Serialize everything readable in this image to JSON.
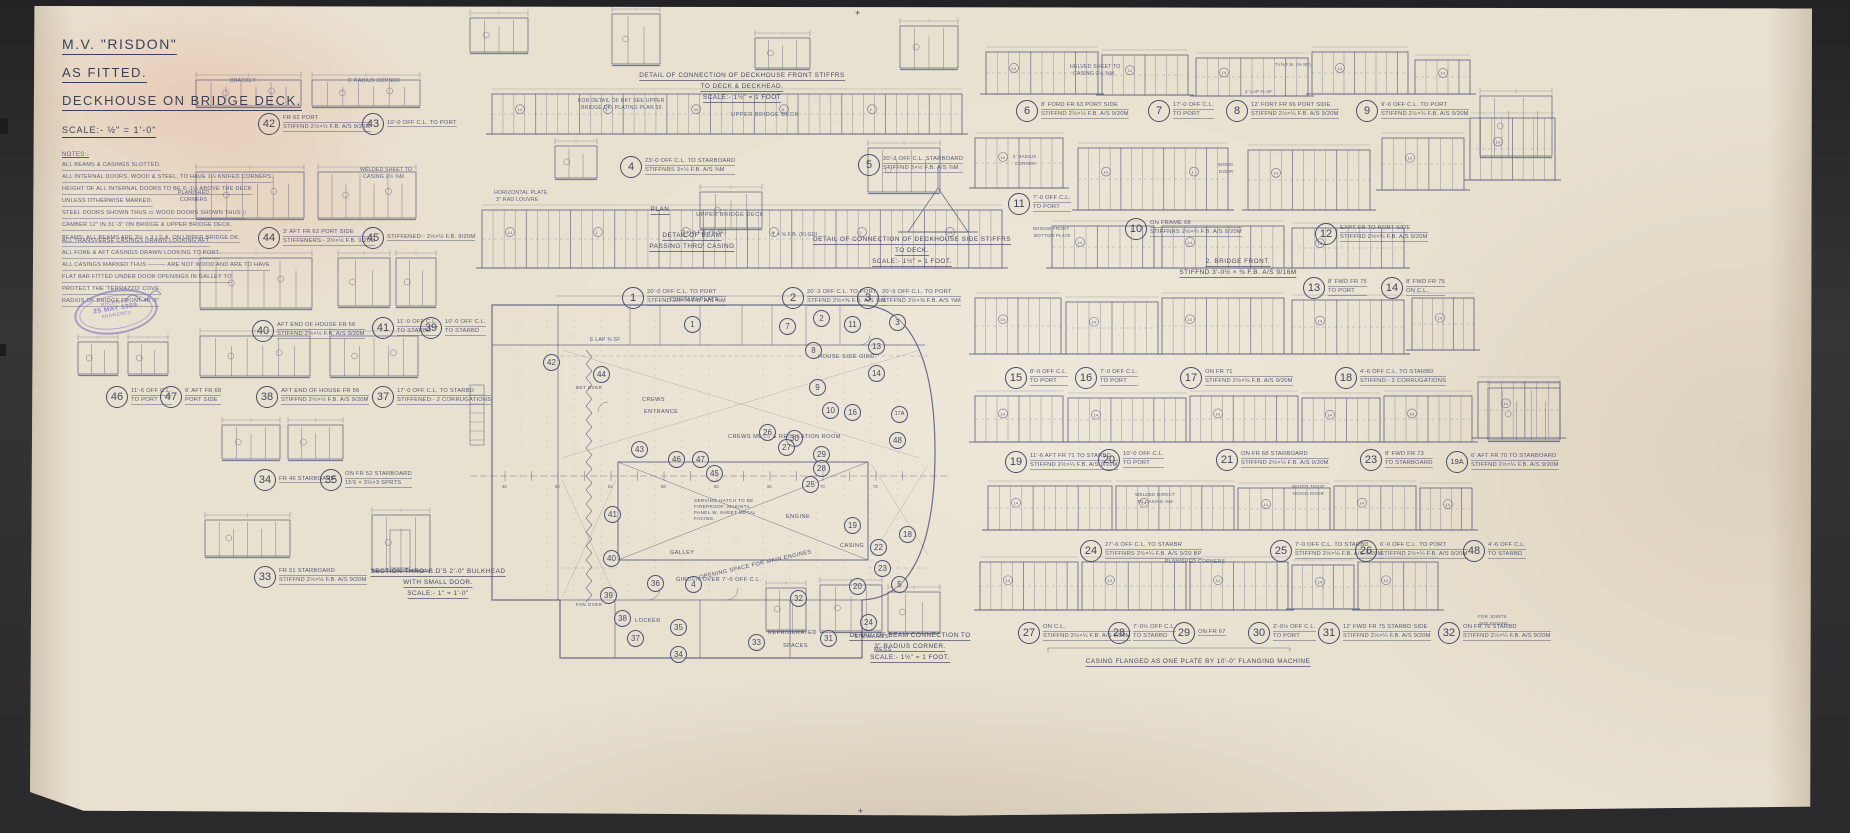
{
  "window": {
    "width": 1850,
    "height": 833
  },
  "colors": {
    "ink": "#464c68",
    "ink_light": "#5b6282",
    "paper": "#e9e1d0",
    "stamp": "#7d74c0",
    "surround": "#2d2d2f"
  },
  "title_block": {
    "vessel": "M.V. \"RISDON\"",
    "status": "AS FITTED.",
    "subject": "DECKHOUSE ON BRIDGE DECK.",
    "scale": "SCALE:- ½\" = 1'-0\"",
    "notes_heading": "NOTES:-",
    "notes": [
      "ALL BEAMS & CASINGS SLOTTED.",
      "ALL INTERNAL DOORS, WOOD & STEEL, TO HAVE 1¼ KNIFED CORNERS.",
      "HEIGHT OF ALL INTERNAL DOORS TO BE 6'-1½ ABOVE THE DECK",
      "UNLESS OTHERWISE MARKED.",
      "STEEL DOORS SHOWN THUS ▭    WOOD DOORS SHOWN THUS ▯",
      "CAMBER 12\" IN 31'-3\" ON BRIDGE & UPPER BRIDGE DECK.",
      "BEAMS: ALL BEAMS ARE 3½ × 3  I.S.A. ON UPPER BRIDGE DK."
    ],
    "notes2": [
      "ALL TRANSVERSE CASINGS DRAWN LOOKING AFT.",
      "ALL FORE & AFT CASINGS DRAWN LOOKING TO PORT.",
      "ALL CASINGS MARKED THUS ——— ARE NOT WOOD AND ARE TO HAVE",
      "FLAT BAR FITTED UNDER DOOR OPENINGS IN GALLEY TO",
      "PROTECT THE 'TERRAZZO' COVE.",
      "RADIUS OF BRIDGE FRONT 48'-3\""
    ]
  },
  "stamp": {
    "top": "RECEIVED",
    "date": "25 MAY 1959",
    "bottom": "ANSWERED"
  },
  "headings": [
    {
      "x": 712,
      "y": 66,
      "lines": [
        "DETAIL OF CONNECTION OF DECKHOUSE FRONT STIFFRS",
        "TO DECK & DECKHEAD.",
        "SCALE:- 1½\" = 1 FOOT"
      ]
    },
    {
      "x": 630,
      "y": 200,
      "lines": [
        "PLAN"
      ]
    },
    {
      "x": 662,
      "y": 226,
      "lines": [
        "DETAIL OF BEAM",
        "PASSING THRO' CASING"
      ]
    },
    {
      "x": 882,
      "y": 230,
      "lines": [
        "DETAIL OF CONNECTION OF DECKHOUSE SIDE STIFFRS",
        "TO DECK.",
        "SCALE:- 1½\" = 1 FOOT."
      ]
    },
    {
      "x": 880,
      "y": 626,
      "lines": [
        "DETAIL OF BEAM CONNECTION TO",
        "3\" RADIUS CORNER.",
        "SCALE:- 1½\" = 1 FOOT."
      ]
    },
    {
      "x": 408,
      "y": 562,
      "lines": [
        "SECTION THRO' B.D'S 2'-0\" BULKHEAD",
        "WITH SMALL DOOR.",
        "SCALE:- 1\" = 1'-0\""
      ]
    },
    {
      "x": 1208,
      "y": 252,
      "lines": [
        "2. BRIDGE FRONT.",
        "STIFFND 3'-0½ × ⅜ F.B. A/S 9/16M"
      ]
    },
    {
      "x": 1168,
      "y": 652,
      "lines": [
        "CASING FLANGED AS ONE PLATE BY 10'-0\" FLANGING MACHINE"
      ]
    },
    {
      "x": 735,
      "y": 106,
      "small": true,
      "lines": [
        "UPPER BRIDGE DECK"
      ]
    },
    {
      "x": 700,
      "y": 206,
      "small": true,
      "lines": [
        "UPPER BRIDGE DECK"
      ]
    }
  ],
  "details": [
    {
      "n": "42",
      "x": 228,
      "y": 107,
      "lines": [
        "FR 62 PORT",
        "STIFFND 2½×½ F.B. A/S 9/20M"
      ],
      "sk": [
        196,
        80,
        105,
        26
      ]
    },
    {
      "n": "43",
      "x": 332,
      "y": 107,
      "lines": [
        "10'-0 OFF C.L. TO PORT"
      ],
      "sk": [
        312,
        80,
        108,
        26
      ]
    },
    {
      "n": "44",
      "x": 228,
      "y": 221,
      "lines": [
        "3' AFT FR 62 PORT SIDE",
        "STIFFENERS:- 2½×½ F.B. 9/20M"
      ],
      "sk": [
        196,
        172,
        108,
        46
      ]
    },
    {
      "n": "45",
      "x": 332,
      "y": 221,
      "lines": [
        "STIFFENED:- 2½×½ F.B. 9/20M"
      ],
      "sk": [
        318,
        172,
        98,
        46
      ]
    },
    {
      "n": "40",
      "x": 222,
      "y": 314,
      "lines": [
        "AFT END OF HOUSE FR 56",
        "STIFFND 2½×½ F.B. A/S 9/20M"
      ],
      "sk": [
        200,
        258,
        112,
        50
      ]
    },
    {
      "n": "41",
      "x": 342,
      "y": 311,
      "lines": [
        "11'-0 OFF C.L.",
        "TO STARBD"
      ],
      "sk": [
        338,
        258,
        52,
        48
      ]
    },
    {
      "n": "39",
      "x": 390,
      "y": 311,
      "lines": [
        "10'-0 OFF C.L.",
        "TO STARBD"
      ],
      "sk": [
        396,
        258,
        40,
        48
      ]
    },
    {
      "n": "46",
      "x": 76,
      "y": 380,
      "lines": [
        "11'-6 OFF C.L.",
        "TO PORT"
      ],
      "sk": [
        78,
        342,
        40,
        32
      ]
    },
    {
      "n": "47",
      "x": 130,
      "y": 380,
      "lines": [
        "6' AFT FR 68",
        "PORT SIDE"
      ],
      "sk": [
        128,
        342,
        40,
        32
      ]
    },
    {
      "n": "38",
      "x": 226,
      "y": 380,
      "lines": [
        "AFT END OF HOUSE FR 56",
        "STIFFND 2½×½ F.B. A/S 9/20M"
      ],
      "sk": [
        200,
        336,
        110,
        40
      ]
    },
    {
      "n": "37",
      "x": 342,
      "y": 380,
      "lines": [
        "17'-0 OFF C.L. TO STARBD",
        "STIFFENED:- 2 CORRUGATIONS"
      ],
      "sk": [
        330,
        336,
        88,
        40
      ]
    },
    {
      "n": "34",
      "x": 224,
      "y": 463,
      "lines": [
        "FR 46 STARBOARD"
      ],
      "sk": [
        222,
        425,
        58,
        34
      ]
    },
    {
      "n": "35",
      "x": 290,
      "y": 463,
      "lines": [
        "ON FR 52 STARBOARD",
        "15'6 × 3½×3 SPRTS"
      ],
      "sk": [
        288,
        425,
        55,
        34
      ]
    },
    {
      "n": "33",
      "x": 224,
      "y": 560,
      "lines": [
        "FR 51 STARBOARD",
        "STIFFND 2½×½ F.B. A/S 9/20M"
      ],
      "sk": [
        205,
        520,
        85,
        36
      ]
    },
    {
      "n": "4",
      "x": 590,
      "y": 150,
      "lines": [
        "23'-0 OFF C.L. TO STARBOARD",
        "STIFFNRS 3×½ F.B. A/S ⅜M"
      ]
    },
    {
      "n": "5",
      "x": 828,
      "y": 148,
      "lines": [
        "20'-3 OFF C.L. STARBOARD",
        "STIFFND 3×½ F.B. A/S ⅜M"
      ]
    },
    {
      "n": "1",
      "x": 592,
      "y": 281,
      "lines": [
        "20'-0 OFF C.L. TO PORT",
        "STFFND 2½×⅜ F.B. A/S ⅜M"
      ]
    },
    {
      "n": "2",
      "x": 752,
      "y": 281,
      "lines": [
        "20'-3 OFF C.L. TO PORT",
        "STFFND 2½×⅜ F.B. A/S ⅜M"
      ]
    },
    {
      "n": "3",
      "x": 827,
      "y": 281,
      "lines": [
        "20'-9 OFF C.L. TO PORT",
        "STFFND 2½×⅜ F.B. A/S ⅜M"
      ]
    },
    {
      "n": "6",
      "x": 986,
      "y": 94,
      "lines": [
        "8' FORD FR 63 PORT SIDE",
        "STIFFND 2½×¼ F.B. A/S 9/20M"
      ]
    },
    {
      "n": "7",
      "x": 1118,
      "y": 94,
      "lines": [
        "17'-0 OFF C.L.",
        "TO PORT"
      ]
    },
    {
      "n": "8",
      "x": 1196,
      "y": 94,
      "lines": [
        "12' FORT FR 66 PORT SIDE",
        "STIFFND 2½×¼ F.B. A/S 9/20M"
      ]
    },
    {
      "n": "9",
      "x": 1326,
      "y": 94,
      "lines": [
        "9'-6 OFF C.L. TO PORT",
        "STIFFND 2½×¼ F.B. A/S 9/20M"
      ]
    },
    {
      "n": "11",
      "x": 978,
      "y": 187,
      "lines": [
        "7'-0 OFF C.L.",
        "TO PORT"
      ]
    },
    {
      "n": "10",
      "x": 1095,
      "y": 212,
      "lines": [
        "ON FRAME 68",
        "STIFFNRS 2½×¼ F.B. A/S 9/20M"
      ]
    },
    {
      "n": "12",
      "x": 1285,
      "y": 217,
      "lines": [
        "EXPT FR TO PORT SIDE",
        "STIFFND 2½×¼ F.B. A/S 9/20M"
      ]
    },
    {
      "n": "13",
      "x": 1273,
      "y": 271,
      "lines": [
        "8' FWD FR 75",
        "TO PORT"
      ]
    },
    {
      "n": "14",
      "x": 1351,
      "y": 271,
      "lines": [
        "8' FWD FR 75",
        "ON C.L."
      ]
    },
    {
      "n": "15",
      "x": 975,
      "y": 361,
      "lines": [
        "8'-0 OFF C.L.",
        "TO PORT"
      ]
    },
    {
      "n": "16",
      "x": 1045,
      "y": 361,
      "lines": [
        "7'-0 OFF C.L.",
        "TO PORT"
      ]
    },
    {
      "n": "17",
      "x": 1150,
      "y": 361,
      "lines": [
        "ON FR 71",
        "STIFFND 2½×¼ F.B. A/S 9/20M"
      ]
    },
    {
      "n": "18",
      "x": 1305,
      "y": 361,
      "lines": [
        "4'-6 OFF C.L. TO STARBD",
        "STIFFND:- 2 CORRUGATIONS"
      ]
    },
    {
      "n": "19",
      "x": 975,
      "y": 445,
      "lines": [
        "11'-6 AFT FR 71 TO STARBD",
        "STIFFND 2½×¼ F.B. A/S 9/20M"
      ]
    },
    {
      "n": "20",
      "x": 1068,
      "y": 443,
      "lines": [
        "10'-0 OFF C.L.",
        "TO PORT"
      ]
    },
    {
      "n": "21",
      "x": 1186,
      "y": 443,
      "lines": [
        "ON FR 68 STARBOARD",
        "STIFFND 2½×¼ F.B. A/S 9/20M"
      ]
    },
    {
      "n": "23",
      "x": 1330,
      "y": 443,
      "lines": [
        "8' FWD FR 73",
        "TO STARBOARD"
      ]
    },
    {
      "n": "19A",
      "x": 1416,
      "y": 445,
      "lines": [
        "6' AFT FR 70 TO STARBOARD",
        "STIFFND 2½×¼ F.B. A/S 9/20M"
      ]
    },
    {
      "n": "24",
      "x": 1050,
      "y": 534,
      "lines": [
        "27'-6 OFF C.L. TO STARBR",
        "STIFFNRS 2½×¼ F.B. A/S 9/20 BP"
      ]
    },
    {
      "n": "25",
      "x": 1240,
      "y": 534,
      "lines": [
        "7'-0 OFF C.L. TO STARBD",
        "STIFFND 2½×¼ F.B. A/S 9/20M"
      ]
    },
    {
      "n": "26",
      "x": 1325,
      "y": 534,
      "lines": [
        "6'-0 OFF C.L. TO PORT",
        "STIFFND 2½×¼ F.B. A/S 9/20M"
      ]
    },
    {
      "n": "48",
      "x": 1433,
      "y": 534,
      "lines": [
        "4'-6 OFF C.L.",
        "TO STARBD"
      ]
    },
    {
      "n": "27",
      "x": 988,
      "y": 616,
      "lines": [
        "ON C.L.",
        "STIFFND 2½×¼ F.B. A/S 9/20M"
      ]
    },
    {
      "n": "28",
      "x": 1078,
      "y": 616,
      "lines": [
        "7'-0½ OFF C.L.",
        "TO STARBD"
      ]
    },
    {
      "n": "29",
      "x": 1143,
      "y": 616,
      "lines": [
        "ON FR 67"
      ]
    },
    {
      "n": "30",
      "x": 1218,
      "y": 616,
      "lines": [
        "2'-0½ OFF C.L.",
        "TO PORT"
      ]
    },
    {
      "n": "31",
      "x": 1288,
      "y": 616,
      "lines": [
        "12' FWD FR 75 STARBD SIDE",
        "STIFFND 2½×¼ F.B. A/S 9/20M"
      ]
    },
    {
      "n": "32",
      "x": 1408,
      "y": 616,
      "lines": [
        "ON FR 76 STARBD",
        "STIFFND 2½×¼ F.B. A/S 9/20M"
      ]
    }
  ],
  "plan": {
    "labels": [
      {
        "t": "CURTAIN PLATE",
        "x": 640,
        "y": 291
      },
      {
        "t": "HOUSE SIDE GIRD.",
        "x": 788,
        "y": 348
      },
      {
        "t": "CREWS",
        "x": 612,
        "y": 391
      },
      {
        "t": "ENTRANCE",
        "x": 614,
        "y": 403
      },
      {
        "t": "CREWS MESS & RECREATION ROOM",
        "x": 698,
        "y": 428
      },
      {
        "t": "SERVING HATCH TO BE",
        "x": 664,
        "y": 492,
        "s": 4.5
      },
      {
        "t": "FIREPROOF. MAKINTA",
        "x": 664,
        "y": 498,
        "s": 4.5
      },
      {
        "t": "PANEL W. SHEET METAL",
        "x": 664,
        "y": 504,
        "s": 4.5
      },
      {
        "t": "FACING.",
        "x": 664,
        "y": 510,
        "s": 4.5
      },
      {
        "t": "GALLEY",
        "x": 640,
        "y": 544
      },
      {
        "t": "ENGINE",
        "x": 756,
        "y": 508
      },
      {
        "t": "CASING",
        "x": 810,
        "y": 537
      },
      {
        "t": "OPENING SPACE FOR MAIN ENGINES",
        "x": 668,
        "y": 556,
        "r": -13
      },
      {
        "t": "GIRDER OVER 7'-0 OFF C.L.",
        "x": 646,
        "y": 571
      },
      {
        "t": "LOCKER",
        "x": 605,
        "y": 612
      },
      {
        "t": "REFRIGERATED",
        "x": 738,
        "y": 624
      },
      {
        "t": "SPACES",
        "x": 753,
        "y": 637
      },
      {
        "t": "STEWARDS",
        "x": 824,
        "y": 628
      },
      {
        "t": "MESS",
        "x": 844,
        "y": 641
      },
      {
        "t": "BKT OVER",
        "x": 546,
        "y": 379,
        "s": 4.5
      },
      {
        "t": "FAN OVER",
        "x": 546,
        "y": 596,
        "s": 4.5
      }
    ],
    "circles": [
      {
        "n": "1",
        "x": 662,
        "y": 318
      },
      {
        "n": "7",
        "x": 757,
        "y": 320
      },
      {
        "n": "2",
        "x": 791,
        "y": 312
      },
      {
        "n": "11",
        "x": 822,
        "y": 318
      },
      {
        "n": "3",
        "x": 867,
        "y": 316
      },
      {
        "n": "8",
        "x": 783,
        "y": 344
      },
      {
        "n": "13",
        "x": 846,
        "y": 340
      },
      {
        "n": "14",
        "x": 846,
        "y": 367
      },
      {
        "n": "9",
        "x": 787,
        "y": 381
      },
      {
        "n": "10",
        "x": 800,
        "y": 404
      },
      {
        "n": "16",
        "x": 822,
        "y": 406
      },
      {
        "n": "17A",
        "x": 869,
        "y": 408
      },
      {
        "n": "48",
        "x": 867,
        "y": 434
      },
      {
        "n": "26",
        "x": 737,
        "y": 426
      },
      {
        "n": "30",
        "x": 764,
        "y": 432
      },
      {
        "n": "27",
        "x": 756,
        "y": 441
      },
      {
        "n": "29",
        "x": 791,
        "y": 448
      },
      {
        "n": "28",
        "x": 791,
        "y": 462
      },
      {
        "n": "25",
        "x": 780,
        "y": 478
      },
      {
        "n": "19",
        "x": 822,
        "y": 519
      },
      {
        "n": "18",
        "x": 877,
        "y": 528
      },
      {
        "n": "22",
        "x": 848,
        "y": 541
      },
      {
        "n": "23",
        "x": 852,
        "y": 562
      },
      {
        "n": "5",
        "x": 869,
        "y": 578
      },
      {
        "n": "20",
        "x": 827,
        "y": 580
      },
      {
        "n": "4",
        "x": 663,
        "y": 578
      },
      {
        "n": "42",
        "x": 521,
        "y": 356
      },
      {
        "n": "44",
        "x": 571,
        "y": 368
      },
      {
        "n": "43",
        "x": 609,
        "y": 443
      },
      {
        "n": "46",
        "x": 646,
        "y": 453
      },
      {
        "n": "47",
        "x": 670,
        "y": 453
      },
      {
        "n": "45",
        "x": 684,
        "y": 467
      },
      {
        "n": "41",
        "x": 582,
        "y": 508
      },
      {
        "n": "40",
        "x": 581,
        "y": 552
      },
      {
        "n": "36",
        "x": 625,
        "y": 577
      },
      {
        "n": "39",
        "x": 578,
        "y": 589
      },
      {
        "n": "38",
        "x": 592,
        "y": 612
      },
      {
        "n": "37",
        "x": 605,
        "y": 632
      },
      {
        "n": "35",
        "x": 648,
        "y": 621
      },
      {
        "n": "34",
        "x": 648,
        "y": 648
      },
      {
        "n": "33",
        "x": 726,
        "y": 636
      },
      {
        "n": "31",
        "x": 798,
        "y": 632
      },
      {
        "n": "24",
        "x": 838,
        "y": 616
      },
      {
        "n": "32",
        "x": 768,
        "y": 592
      }
    ],
    "frame_numbers": [
      "46",
      "48",
      "50",
      "52",
      "54",
      "56",
      "58",
      "60",
      "62",
      "64",
      "66",
      "68",
      "70",
      "72",
      "74",
      "76"
    ]
  },
  "floaters": [
    {
      "t": "FOR DETAIL OF BKT SEE UPPER",
      "x": 548,
      "y": 92
    },
    {
      "t": "BRIDGE DK. PLATING PLAN 59.",
      "x": 551,
      "y": 99
    },
    {
      "t": "BRACKET",
      "x": 200,
      "y": 72
    },
    {
      "t": "5' RADIUS CORNER",
      "x": 318,
      "y": 72
    },
    {
      "t": "WELDED SHEET TO",
      "x": 330,
      "y": 161
    },
    {
      "t": "CASING 2½ ⅜M",
      "x": 333,
      "y": 168
    },
    {
      "t": "PLANISHED",
      "x": 148,
      "y": 184
    },
    {
      "t": "CORNERS",
      "x": 150,
      "y": 191
    },
    {
      "t": "HORIZONTAL PLATE",
      "x": 464,
      "y": 184
    },
    {
      "t": "3\" RAD LOUVRE",
      "x": 466,
      "y": 191
    },
    {
      "t": "7 × ⅝ F.B. (⅜ SF)",
      "x": 652,
      "y": 224
    },
    {
      "t": "7 × ⅝ F.B. (FLGD)",
      "x": 742,
      "y": 226
    },
    {
      "t": "E LAP ⅜ SF",
      "x": 560,
      "y": 331
    },
    {
      "t": "HELVED SHEET TO",
      "x": 1040,
      "y": 58
    },
    {
      "t": "CASING 2½ ⅜M",
      "x": 1043,
      "y": 65
    },
    {
      "t": "WOOD",
      "x": 1188,
      "y": 156,
      "s": 4.5
    },
    {
      "t": "DOOR",
      "x": 1189,
      "y": 163,
      "s": 4.5
    },
    {
      "t": "WATER TIGHT",
      "x": 1262,
      "y": 478,
      "s": 4.5
    },
    {
      "t": "WOOD DOOR",
      "x": 1263,
      "y": 485,
      "s": 4.5
    },
    {
      "t": "WELDED DIRECT",
      "x": 1105,
      "y": 486,
      "s": 4.5
    },
    {
      "t": "TO CASING ⅜M",
      "x": 1107,
      "y": 493,
      "s": 4.5
    },
    {
      "t": "PLANISHED CORNERS",
      "x": 1135,
      "y": 553
    },
    {
      "t": "5' RADIUS",
      "x": 983,
      "y": 148,
      "s": 4.5
    },
    {
      "t": "CORNER",
      "x": 985,
      "y": 155,
      "s": 4.5
    },
    {
      "t": "2' LAP ⅜ SF",
      "x": 1215,
      "y": 83,
      "s": 4.5
    },
    {
      "t": "7×⅝ F.B. (⅜ SF)",
      "x": 1245,
      "y": 56,
      "s": 4.5
    },
    {
      "t": "BRIDGE FRONT",
      "x": 1003,
      "y": 220,
      "s": 4.5
    },
    {
      "t": "BOTTOM PLATE",
      "x": 1004,
      "y": 227,
      "s": 4.5
    },
    {
      "t": "FOR JOINTS",
      "x": 1448,
      "y": 608,
      "s": 4.5
    },
    {
      "t": "SEE ENGINE",
      "x": 1449,
      "y": 615,
      "s": 4.5
    }
  ],
  "marks": {
    "registration_top": "+",
    "registration_bottom": "+"
  }
}
